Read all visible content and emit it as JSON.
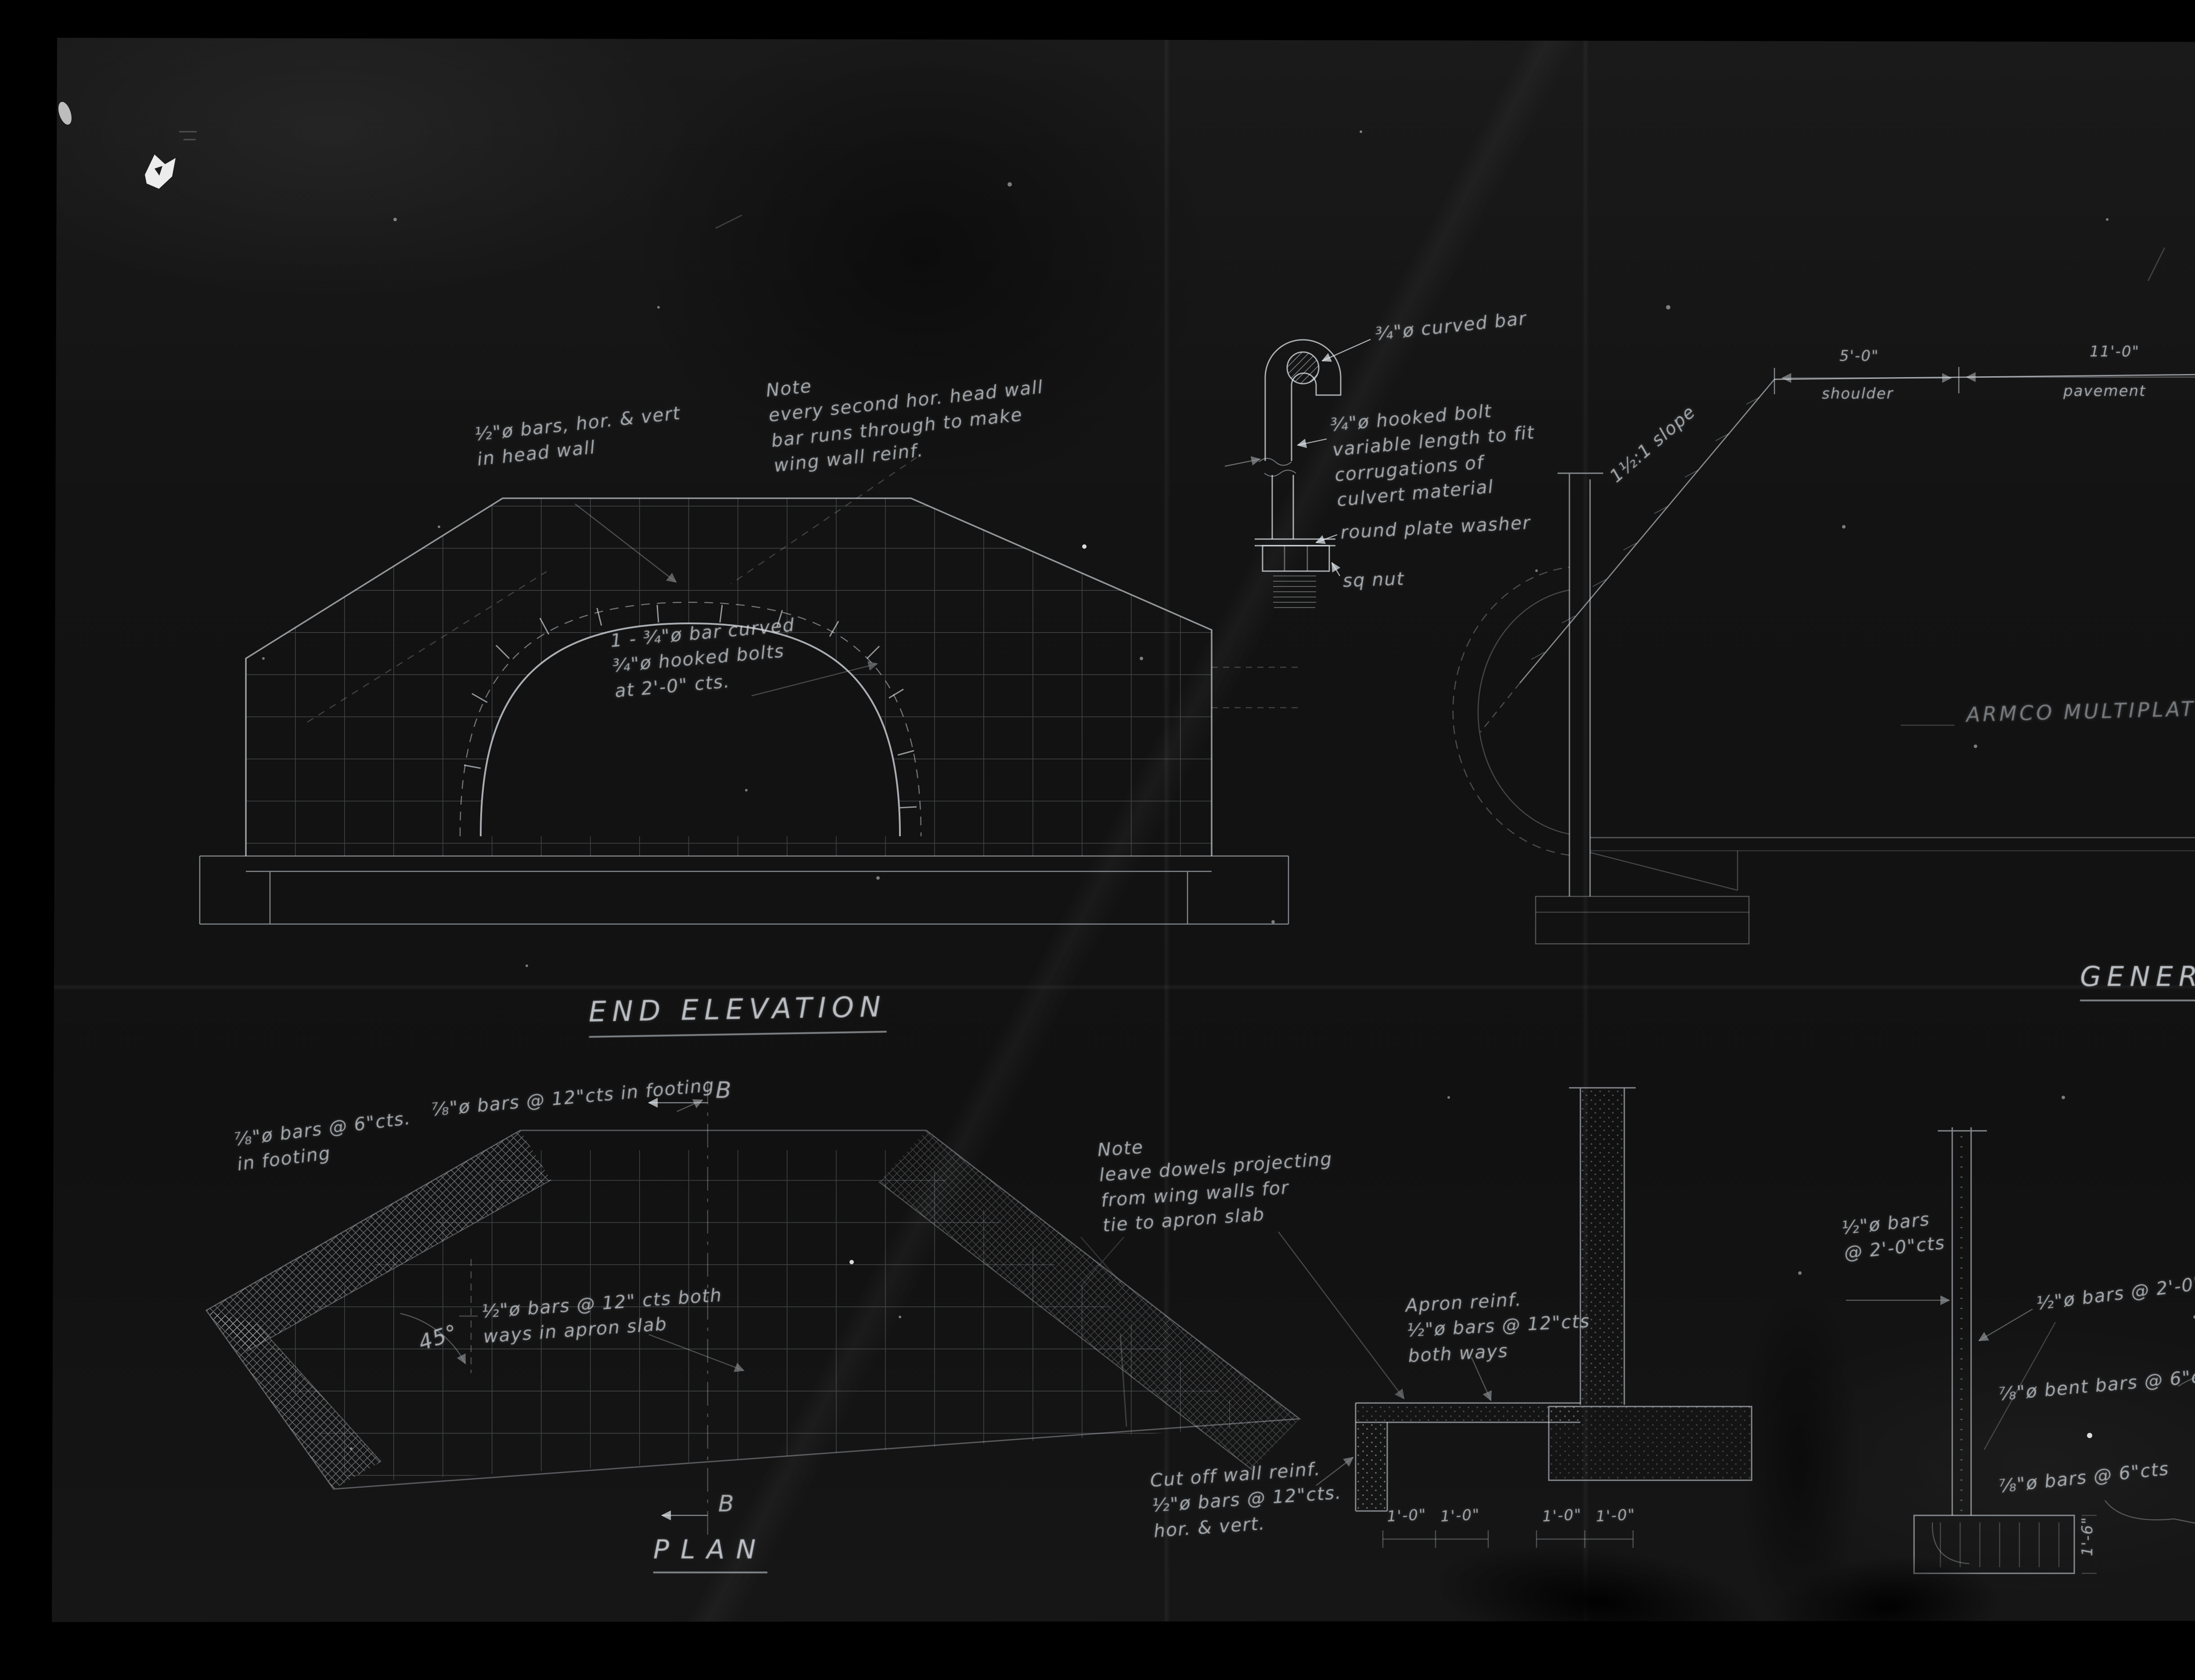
{
  "drawing": {
    "end_elevation": {
      "title": "END ELEVATION",
      "note_headwall_bars": "½\"ø bars, hor. & vert\nin head wall",
      "note_second_bar": "Note\nevery second hor. head wall\nbar runs through to make\nwing wall reinf.",
      "note_arch_bar": "1 - ¾\"ø bar curved\n¾\"ø hooked bolts\nat 2'-0\" cts."
    },
    "bolt_detail": {
      "curved_bar": "¾\"ø curved bar",
      "hooked_bolt": "¾\"ø hooked bolt\nvariable length to fit\ncorrugations of\nculvert material",
      "washer": "round plate washer",
      "nut": "sq nut"
    },
    "general_elevation": {
      "title": "GENERAL ELEVAT",
      "shoulder_dim": "5'-0\"",
      "shoulder_label": "shoulder",
      "pavement_dim": "11'-0\"",
      "pavement_label": "pavement",
      "centerline": "℄ highway",
      "slope": "1½:1 slope",
      "armco": "ARMCO MULTIPLATE PIPE ARCH CU"
    },
    "plan": {
      "title": "PLAN",
      "footing_bars_6": "⅞\"ø bars @ 6\"cts.\nin footing",
      "footing_bars_12": "⅞\"ø bars @ 12\"cts in footing",
      "apron_bars": "½\"ø bars @ 12\" cts both\nways in apron slab",
      "angle": "45°",
      "section_marker": "B"
    },
    "apron_section": {
      "note_dowels": "Note\nleave dowels projecting\nfrom wing walls for\ntie to apron slab",
      "apron_reinf": "Apron reinf.\n½\"ø bars @ 12\"cts\nboth ways",
      "cutoff_reinf": "Cut off wall reinf.\n½\"ø bars @ 12\"cts.\nhor. & vert.",
      "dims": [
        "1'-0\"",
        "1'-0\"",
        "1'-0\"",
        "1'-0\""
      ]
    },
    "wall_sections": {
      "bars_left": "½\"ø bars\n@ 2'-0\"cts",
      "bars_right": "½\"ø bars @ 2'-0\" cts",
      "bent_bars": "⅞\"ø bent bars @ 6\"cts",
      "bars_6": "⅞\"ø bars @ 6\"cts",
      "dim_height": "1'-6\""
    }
  },
  "film_margin": {
    "counter_digits": [
      "8",
      "2",
      "5",
      "",
      "0",
      ""
    ],
    "archive_label": {
      "line1": "National Archives of Canada",
      "line2": "Archives nationales du Canada"
    }
  }
}
